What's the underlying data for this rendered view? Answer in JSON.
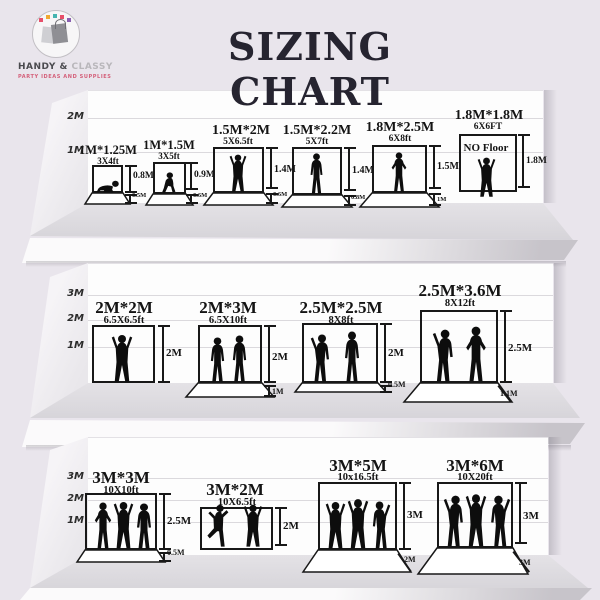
{
  "title": "SIZING CHART",
  "brand": {
    "primary": "HANDY &",
    "secondary": "CLASSY",
    "tagline": "PARTY IDEAS AND SUPPLIES"
  },
  "colors": {
    "background": "#e9e5ec",
    "ink": "#141414",
    "brand_pink": "#d4607a",
    "brand_teal": "#45b5b0"
  },
  "rows": [
    {
      "scale": [
        "2M",
        "1M"
      ],
      "items": [
        {
          "size": "1M*1.25M",
          "feet": "3X4ft",
          "height": "0.8M",
          "floor": "0.5M"
        },
        {
          "size": "1M*1.5M",
          "feet": "3X5ft",
          "height": "0.9M",
          "floor": "0.6M"
        },
        {
          "size": "1.5M*2M",
          "feet": "5X6.5ft",
          "height": "1.4M",
          "floor": "0.6M"
        },
        {
          "size": "1.5M*2.2M",
          "feet": "5X7ft",
          "height": "1.4M",
          "floor": "0.8M"
        },
        {
          "size": "1.8M*2.5M",
          "feet": "6X8ft",
          "height": "1.5M",
          "floor": "1M"
        },
        {
          "size": "1.8M*1.8M",
          "feet": "6X6FT",
          "height": "1.8M",
          "note": "NO Floor"
        }
      ]
    },
    {
      "scale": [
        "3M",
        "2M",
        "1M"
      ],
      "items": [
        {
          "size": "2M*2M",
          "feet": "6.5X6.5ft",
          "height": "2M"
        },
        {
          "size": "2M*3M",
          "feet": "6.5X10ft",
          "height": "2M",
          "floor": "1M"
        },
        {
          "size": "2.5M*2.5M",
          "feet": "8X8ft",
          "height": "2M",
          "floor": "0.5M"
        },
        {
          "size": "2.5M*3.6M",
          "feet": "8X12ft",
          "height": "2.5M",
          "floor": "1.1M"
        }
      ]
    },
    {
      "scale": [
        "3M",
        "2M",
        "1M"
      ],
      "items": [
        {
          "size": "3M*3M",
          "feet": "10X10ft",
          "height": "2.5M",
          "floor": "0.5M"
        },
        {
          "size": "3M*2M",
          "feet": "10X6.5ft",
          "height": "2M"
        },
        {
          "size": "3M*5M",
          "feet": "10x16.5ft",
          "height": "3M",
          "floor": "2M"
        },
        {
          "size": "3M*6M",
          "feet": "10X20ft",
          "height": "3M",
          "floor": "3M"
        }
      ]
    }
  ]
}
